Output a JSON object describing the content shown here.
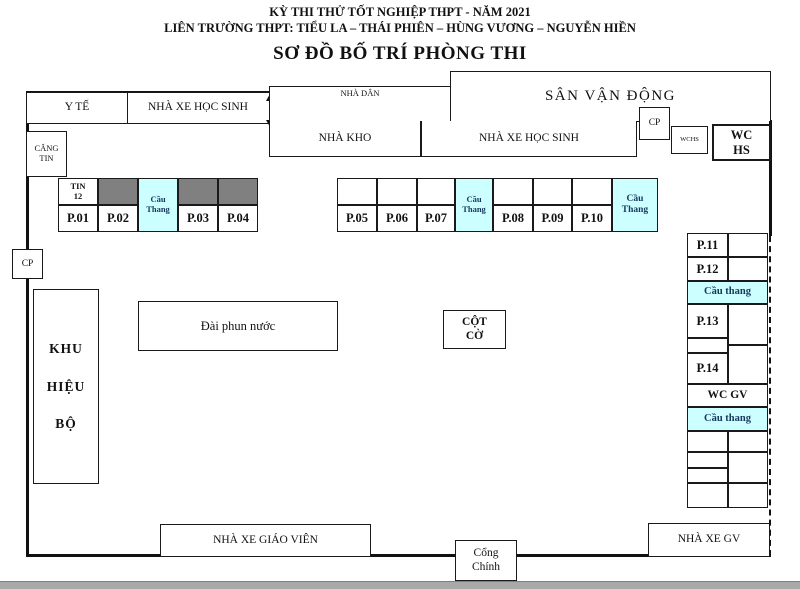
{
  "title": {
    "line1": "KỲ THI THỬ TỐT NGHIỆP THPT - NĂM 2021",
    "line2": "LIÊN TRƯỜNG THPT: TIỂU LA – THÁI PHIÊN – HÙNG VƯƠNG – NGUYỄN HIỀN",
    "line3": "SƠ ĐỒ BỐ TRÍ PHÒNG THI"
  },
  "areas": {
    "y_te": "Y TẾ",
    "nha_xe_hoc_sinh_top": "NHÀ XE HỌC SINH",
    "nha_dan": "NHÀ DÂN",
    "san_van_dong": "SÂN VẬN ĐỘNG",
    "nha_kho": "NHÀ KHO",
    "nha_xe_hoc_sinh_inner": "NHÀ XE HỌC SINH",
    "cp_top": "CP",
    "wchs": "WCHS",
    "wc_hs": [
      "WC",
      "HS"
    ],
    "cang_tin": [
      "CĂNG",
      "TIN"
    ],
    "cp_left": "CP",
    "khu_hieu_bo": [
      "KHU",
      "HIỆU",
      "BỘ"
    ],
    "dai_phun_nuoc": "Đài phun nước",
    "cot_co": [
      "CỘT",
      "CỜ"
    ],
    "wc_gv": "WC GV",
    "nha_xe_giao_vien": "NHÀ XE GIÁO VIÊN",
    "cong_chinh": [
      "Cổng",
      "Chính"
    ],
    "nha_xe_gv": "NHÀ XE GV"
  },
  "rooms": {
    "left": {
      "lab": [
        "TIN",
        "12"
      ],
      "stair": "Cầu Thang",
      "list": [
        "P.01",
        "P.02",
        "P.03",
        "P.04"
      ]
    },
    "middle": {
      "stair1": "Cầu Thang",
      "stair2": "Cầu Thang",
      "list": [
        "P.05",
        "P.06",
        "P.07",
        "P.08",
        "P.09",
        "P.10"
      ]
    },
    "right": {
      "stair1": "Cầu thang",
      "stair2": "Cầu thang",
      "list": [
        "P.11",
        "P.12",
        "P.13",
        "P.14"
      ]
    }
  },
  "colors": {
    "stair_fill": "#CCFFFF",
    "blocked_fill": "#808080",
    "line": "#111111",
    "stair_text": "#17375E",
    "bottom_bar": "#A9A9A9"
  }
}
